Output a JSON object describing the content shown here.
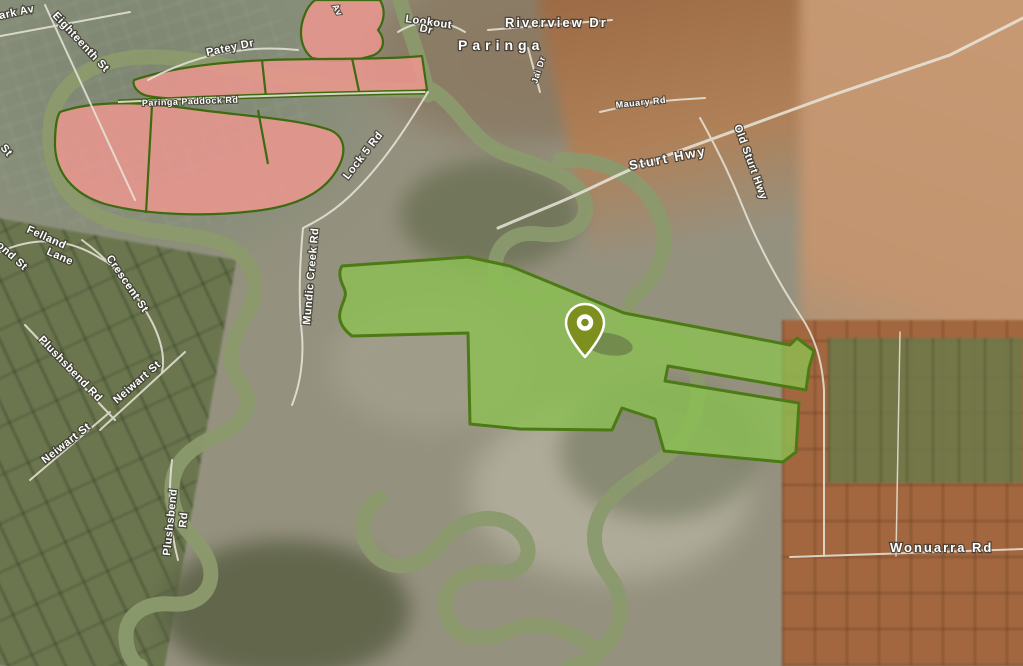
{
  "map": {
    "description": "Satellite map of the Paringa and Renmark area with highlighted land parcels and a location marker",
    "town_label": "Paringa",
    "marker": {
      "name": "location-pin",
      "color": "#7d8f1e",
      "outline": "#ffffff"
    },
    "zones": {
      "green_parcel_fill": "#8cc152",
      "green_parcel_border": "#4c7a15",
      "pink_parcel_fill": "#f29791",
      "pink_parcel_border": "#3e6a10"
    },
    "water_color": "#8b9a6d",
    "labels": {
      "renmark_av": "Renmark Av",
      "eighteenth_st": "Eighteenth St",
      "av_fragment": "Av",
      "patey_dr": "Patey Dr",
      "paringa_paddock_rd": "Paringa Paddock Rd",
      "lookout": "Lookout",
      "lookout_dr": "Dr",
      "riverview_dr": "Riverview Dr",
      "jai_dr": "Jai Dr",
      "mauary_rd": "Mauary Rd",
      "sturt_hwy": "Sturt Hwy",
      "old_sturt_hwy": "Old Sturt Hwy",
      "lock5_rd": "Lock 5 Rd",
      "mundic_creek_rd": "Mundic Creek Rd",
      "felland": "Felland",
      "lane": "Lane",
      "ond_st": "ond St",
      "st_fragment": "St",
      "crescent_st": "Crescent St",
      "plushsbend_rd": "Plushsbend Rd",
      "neiwart_st_1": "Neiwart St",
      "neiwart_st_2": "Neiwart St",
      "plushsbend": "Plushsbend",
      "rd_fragment": "Rd",
      "wonuarra_rd": "Wonuarra Rd"
    }
  }
}
